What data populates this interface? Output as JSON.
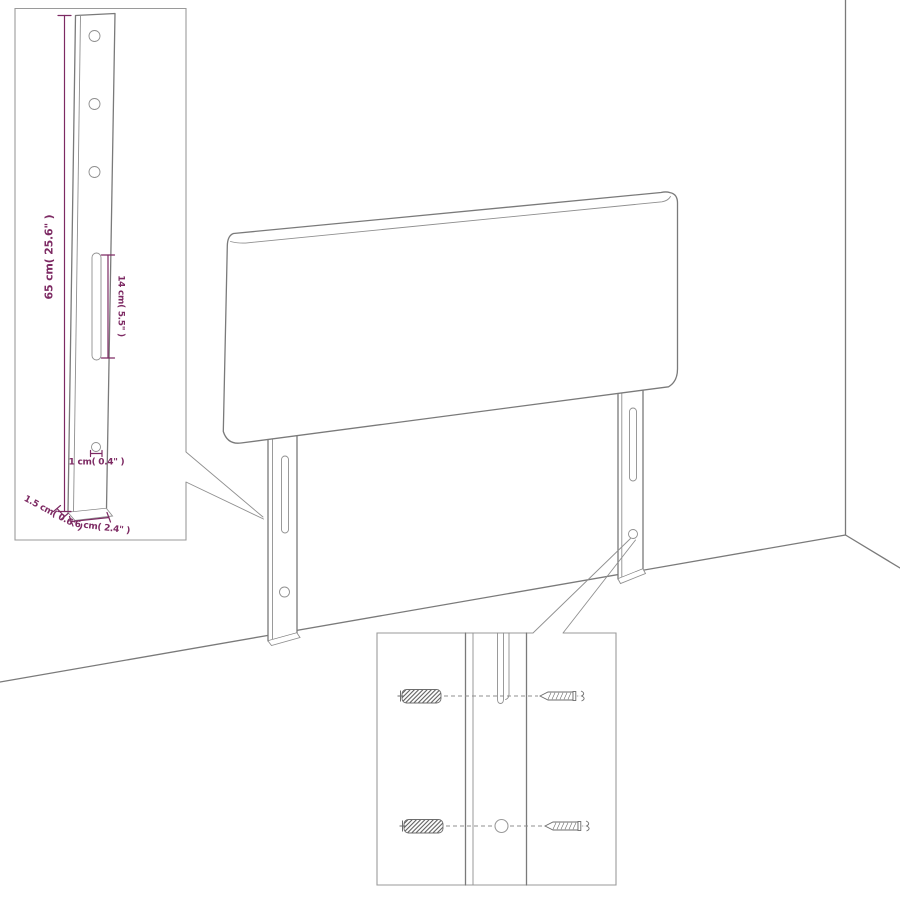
{
  "diagram": {
    "subject": "headboard-assembly-diagram",
    "colors": {
      "line": "#7a7a7a",
      "dimension": "#7d2a63",
      "background": "#ffffff"
    },
    "leg_detail_inset": {
      "height_label": "65 cm( 25.6\" )",
      "slot_length_label": "14 cm( 5.5\" )",
      "bottom_hole_label": "1 cm( 0.4\" )",
      "thickness_label": "1.5 cm( 0.6\" )",
      "width_label": "6 cm( 2.4\" )"
    },
    "hardware_detail_inset": {
      "items": [
        "wall-plug",
        "screw"
      ]
    }
  }
}
